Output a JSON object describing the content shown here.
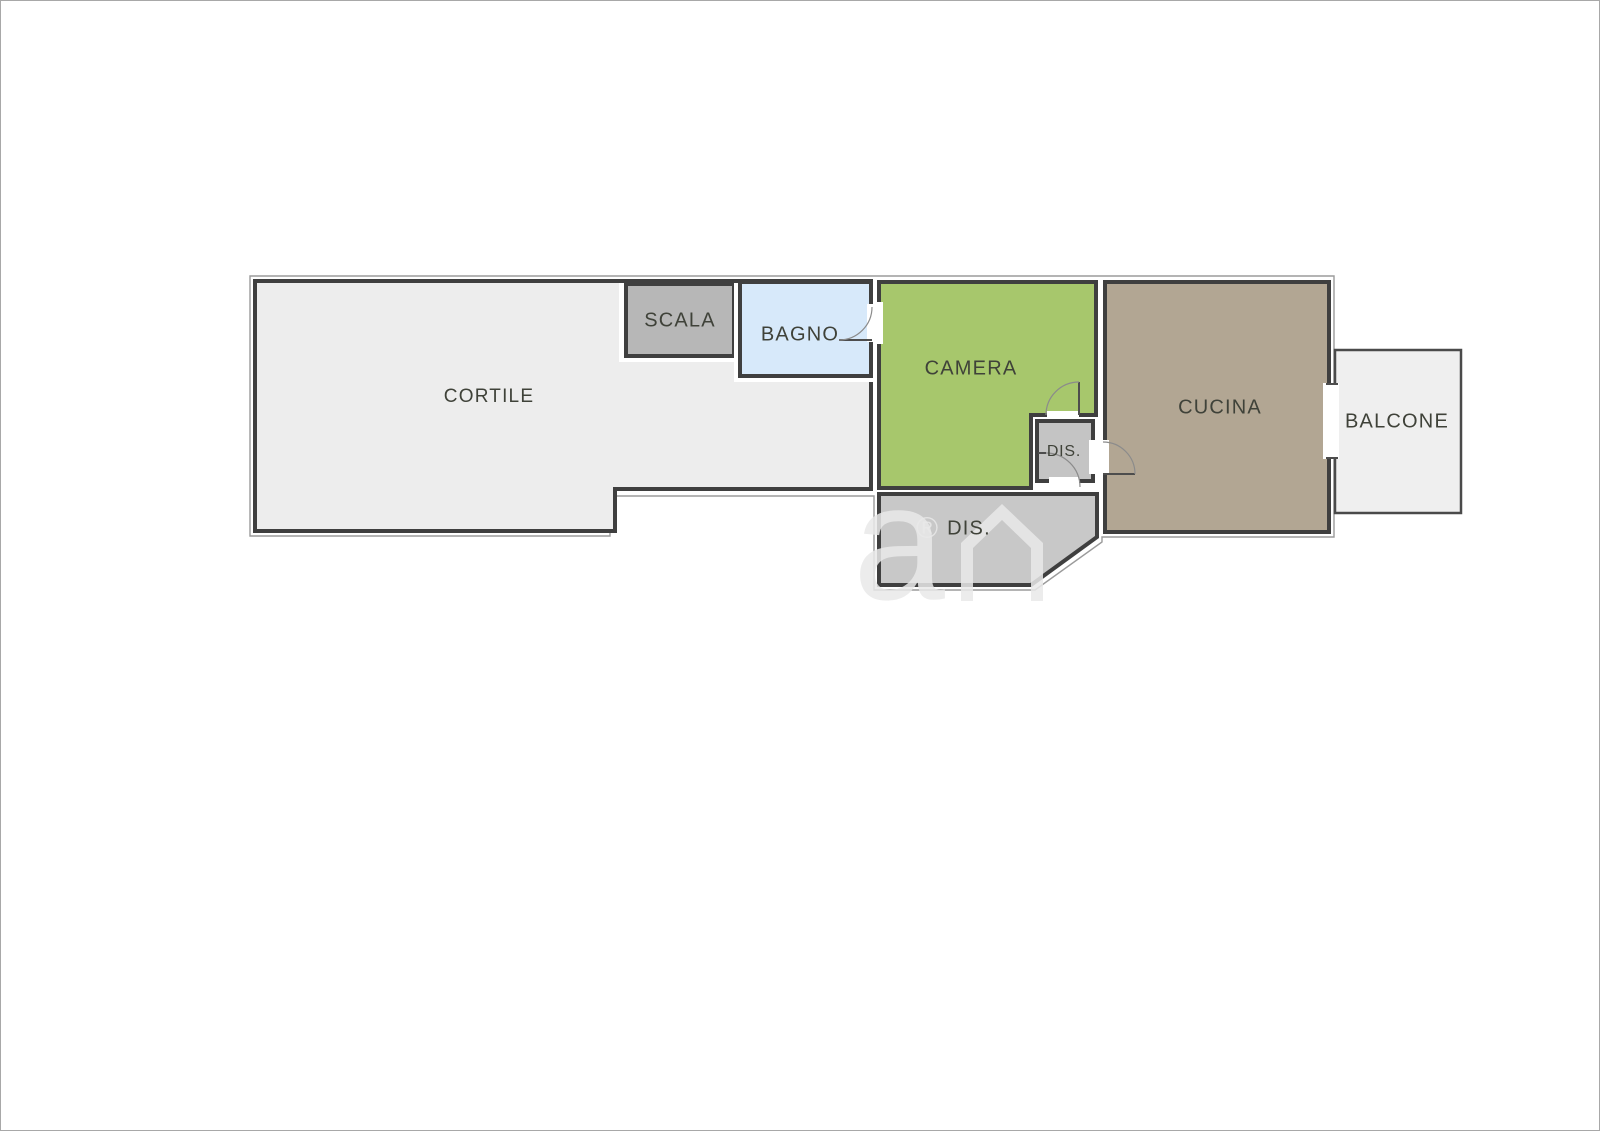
{
  "floorplan": {
    "wall_color": "#3f3f3f",
    "background_color": "#ffffff",
    "rooms": {
      "cortile": {
        "label": "CORTILE",
        "color": "#ededed"
      },
      "scala": {
        "label": "SCALA",
        "color": "#b7b7b7"
      },
      "bagno": {
        "label": "BAGNO",
        "color": "#d7e9fa"
      },
      "camera": {
        "label": "CAMERA",
        "color": "#a7c76c"
      },
      "dis_piccolo": {
        "label": "DIS.",
        "color": "#c4c4c4"
      },
      "dis_grande": {
        "label": "DIS.",
        "color": "#c8c8c8"
      },
      "cucina": {
        "label": "CUCINA",
        "color": "#b2a693"
      },
      "balcone": {
        "label": "BALCONE",
        "color": "#efefef"
      }
    },
    "watermark": {
      "letter": "a",
      "registered_mark": "®"
    }
  }
}
